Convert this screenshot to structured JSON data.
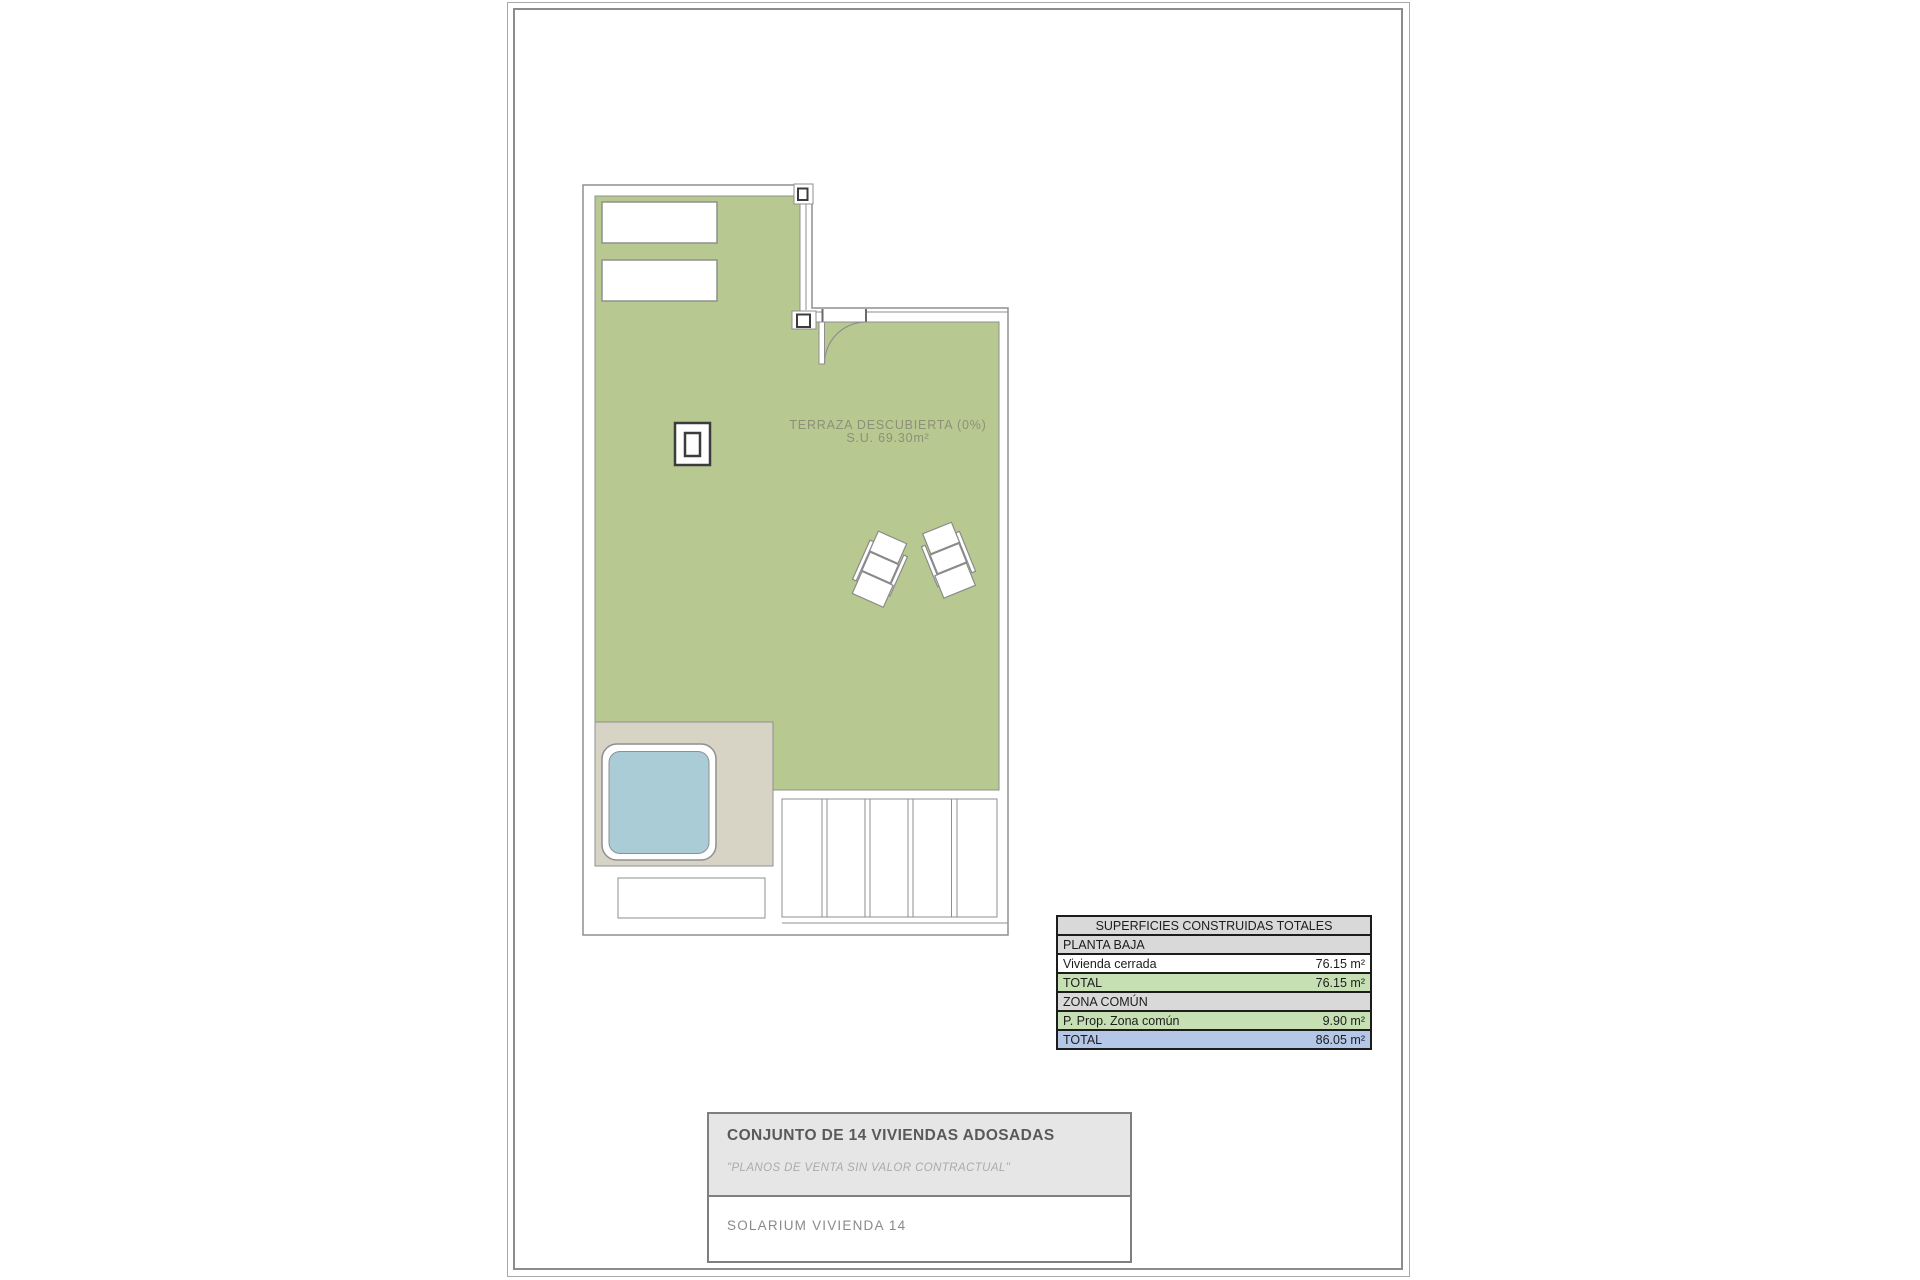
{
  "plan": {
    "area_label_line1": "TERRAZA DESCUBIERTA (0%)",
    "area_label_line2": "S.U. 69.30m²",
    "colors": {
      "terrace_green": "#b7c990",
      "deck_beige": "#d7d3c5",
      "pool_blue": "#a9ccd6",
      "wall_line": "#8f8f8f",
      "dark_line": "#3c3c3c",
      "label_text": "#8c9077"
    }
  },
  "areas_table": {
    "title": "SUPERFICIES CONSTRUIDAS TOTALES",
    "rows": [
      {
        "label": "PLANTA BAJA",
        "value": ""
      },
      {
        "label": "Vivienda cerrada",
        "value": "76.15 m²"
      },
      {
        "label": "TOTAL",
        "value": "76.15 m²"
      },
      {
        "label": "ZONA COMÚN",
        "value": ""
      },
      {
        "label": "P. Prop. Zona común",
        "value": "9.90 m²"
      },
      {
        "label": "TOTAL",
        "value": "86.05 m²"
      }
    ],
    "colors": {
      "header_gray": "#d9d9d9",
      "subtotal_green": "#c6e0b4",
      "total_blue": "#b4c7e7"
    }
  },
  "title_block": {
    "project_title": "CONJUNTO DE 14 VIVIENDAS ADOSADAS",
    "disclaimer": "\"PLANOS DE VENTA SIN VALOR CONTRACTUAL\"",
    "drawing_title": "SOLARIUM VIVIENDA 14"
  }
}
